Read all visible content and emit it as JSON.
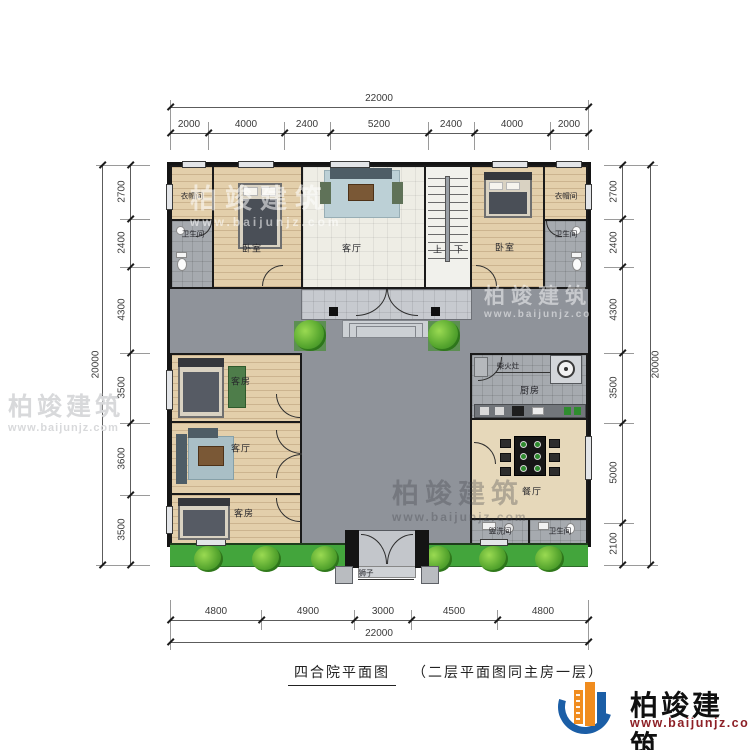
{
  "caption": {
    "title": "四合院平面图",
    "note": "（二层平面图同主房一层）"
  },
  "brand": {
    "name": "柏竣建筑",
    "url": "www.baijunjz.com"
  },
  "watermark": {
    "name": "柏竣建筑",
    "url": "www.baijunjz.com"
  },
  "dims": {
    "top": {
      "total": "22000",
      "segments": [
        "2000",
        "4000",
        "2400",
        "5200",
        "2400",
        "4000",
        "2000"
      ]
    },
    "bottom": {
      "total": "22000",
      "segments": [
        "4800",
        "4900",
        "3000",
        "4500",
        "4800"
      ]
    },
    "left": {
      "total": "20000",
      "segments": [
        "2700",
        "2400",
        "4300",
        "3500",
        "3600",
        "3500"
      ]
    },
    "right": {
      "total": "20000",
      "segments": [
        "2700",
        "2400",
        "4300",
        "3500",
        "5000",
        "2100"
      ]
    }
  },
  "rooms": {
    "cloak_nw": "衣帽间",
    "bath_nw": "卫生间",
    "bedroom_w": "卧室",
    "living_main": "客厅",
    "stairs_up": "上",
    "stairs_down": "下",
    "bedroom_e": "卧室",
    "cloak_ne": "衣帽间",
    "bath_ne": "卫生间",
    "guest_n": "客房",
    "living_w": "客厅",
    "guest_s": "客房",
    "kitchen": "厨房",
    "stove": "柴火灶",
    "dining": "餐厅",
    "wash": "盥洗间",
    "bath_se": "卫生间",
    "lions": "狮子"
  },
  "colors": {
    "wall": "#1a1a1a",
    "courtyard": "#8f939a",
    "grass": "#43a53c",
    "wood_floor": "#e3cfab",
    "logo_blue": "#1b5ea6",
    "logo_orange": "#f08c1e",
    "url_red": "#8d2026"
  }
}
